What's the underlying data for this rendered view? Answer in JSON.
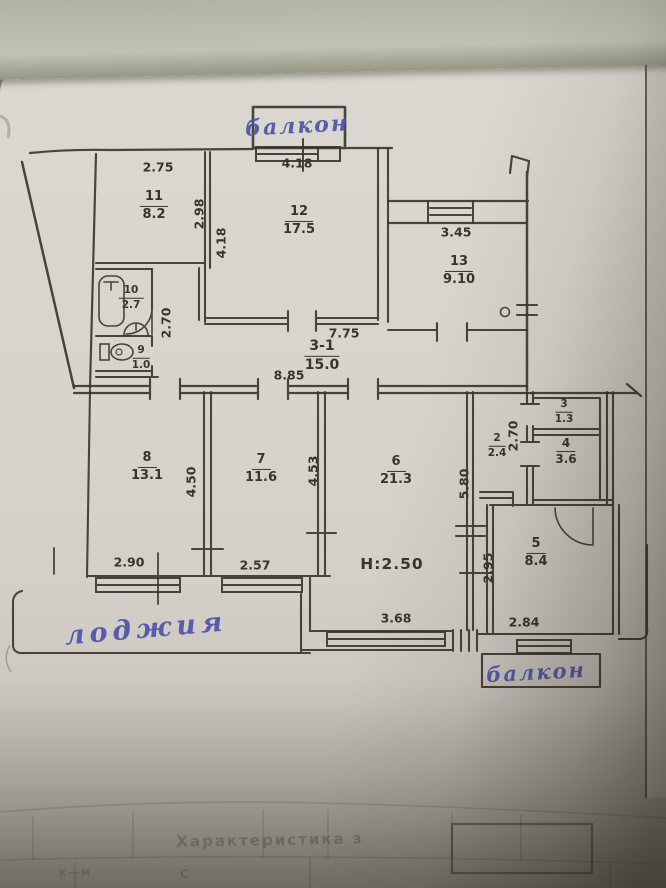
{
  "colors": {
    "paper": "#d8d4cd",
    "table_background": "#b5b7a6",
    "ink": "#3a342e",
    "pen_blue": "#575cab"
  },
  "handwriting": {
    "balcony_top": "балкон",
    "loggia": "лоджия",
    "balcony_bottom": "балкон"
  },
  "rooms": [
    {
      "number": "11",
      "area": "8.2"
    },
    {
      "number": "12",
      "area": "17.5"
    },
    {
      "number": "13",
      "area": "9.10"
    },
    {
      "number": "10",
      "area": "2.7"
    },
    {
      "number": "9",
      "area": "1.0"
    },
    {
      "number": "3-1",
      "area": "15.0"
    },
    {
      "number": "8",
      "area": "13.1"
    },
    {
      "number": "7",
      "area": "11.6"
    },
    {
      "number": "6",
      "area": "21.3"
    },
    {
      "number": "2",
      "area": "2.4"
    },
    {
      "number": "3",
      "area": "1.3"
    },
    {
      "number": "4",
      "area": "3.6"
    },
    {
      "number": "5",
      "area": "8.4"
    }
  ],
  "dimensions": {
    "d2_75": "2.75",
    "d4_18_top": "4.18",
    "d2_98": "2.98",
    "d4_18_side": "4.18",
    "d3_45": "3.45",
    "d2_70_left": "2.70",
    "d7_75": "7.75",
    "d8_85": "8.85",
    "d2_90": "2.90",
    "d4_50": "4.50",
    "d2_57": "2.57",
    "d4_53": "4.53",
    "d5_80": "5.80",
    "d2_70_hall": "2.70",
    "d2_95": "2.95",
    "d2_84": "2.84",
    "d3_68": "3.68",
    "height_note": "H:2.50"
  },
  "bleed_through": {
    "header": "Характеристика з",
    "row_left": "к—м",
    "row_right": "С"
  }
}
